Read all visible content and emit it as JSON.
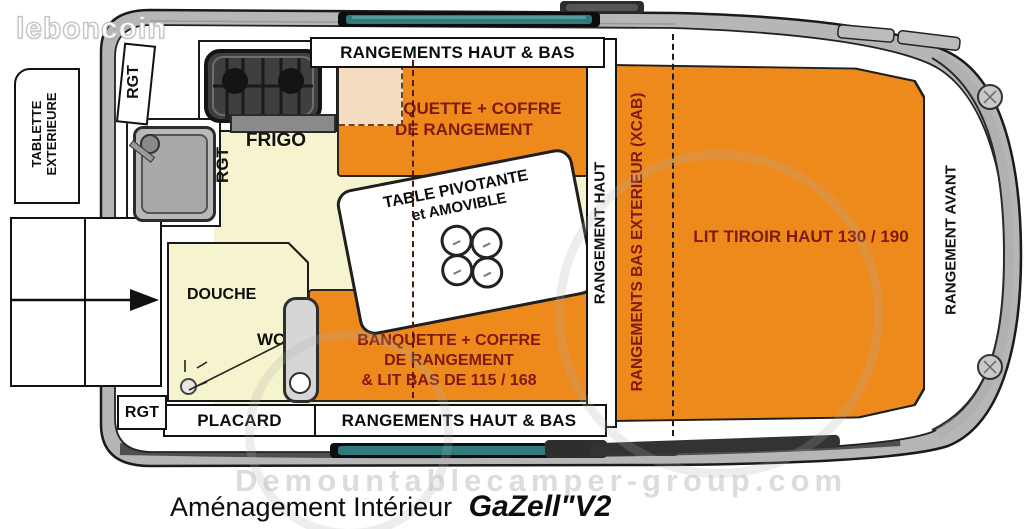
{
  "site_logo": "leboncoin",
  "watermark_url": "Demountablecamper-group.com",
  "caption": {
    "prefix": "Aménagement Intérieur",
    "model": "GaZell\"V2"
  },
  "exterior": {
    "tablette_line1": "TABLETTE",
    "tablette_line2": "EXTERIEURE",
    "rgt_top": "RGT",
    "rgt_bottom": "RGT"
  },
  "kitchen": {
    "frigo": "FRIGO",
    "rgt": "RGT"
  },
  "bathroom": {
    "douche": "DOUCHE",
    "wc": "WC"
  },
  "storage": {
    "top_strip": "RANGEMENTS HAUT & BAS",
    "bottom_strip": "RANGEMENTS HAUT & BAS",
    "placard": "PLACARD",
    "rangement_haut": "RANGEMENT HAUT",
    "rangement_avant": "RANGEMENT AVANT",
    "rangements_bas_exterieur": "RANGEMENTS BAS EXTERIEUR (XCAB)"
  },
  "seating": {
    "banquette_top_line1": "BANQUETTE + COFFRE",
    "banquette_top_line2": "DE RANGEMENT",
    "banquette_bottom_line1": "BANQUETTE + COFFRE",
    "banquette_bottom_line2": "DE RANGEMENT",
    "banquette_bottom_line3": "& LIT BAS DE 115 / 168"
  },
  "table": {
    "line1": "TABLE PIVOTANTE",
    "line2": "et AMOVIBLE"
  },
  "bed": {
    "lit_tiroir": "LIT TIROIR HAUT 130 / 190"
  },
  "colors": {
    "orange": "#ee8a1c",
    "cream": "#f6f4cf",
    "peach": "#f4dcc0",
    "dark_red": "#7e1a10",
    "teal": "#2f7a7c",
    "wall_gray": "#b6b6b6"
  }
}
